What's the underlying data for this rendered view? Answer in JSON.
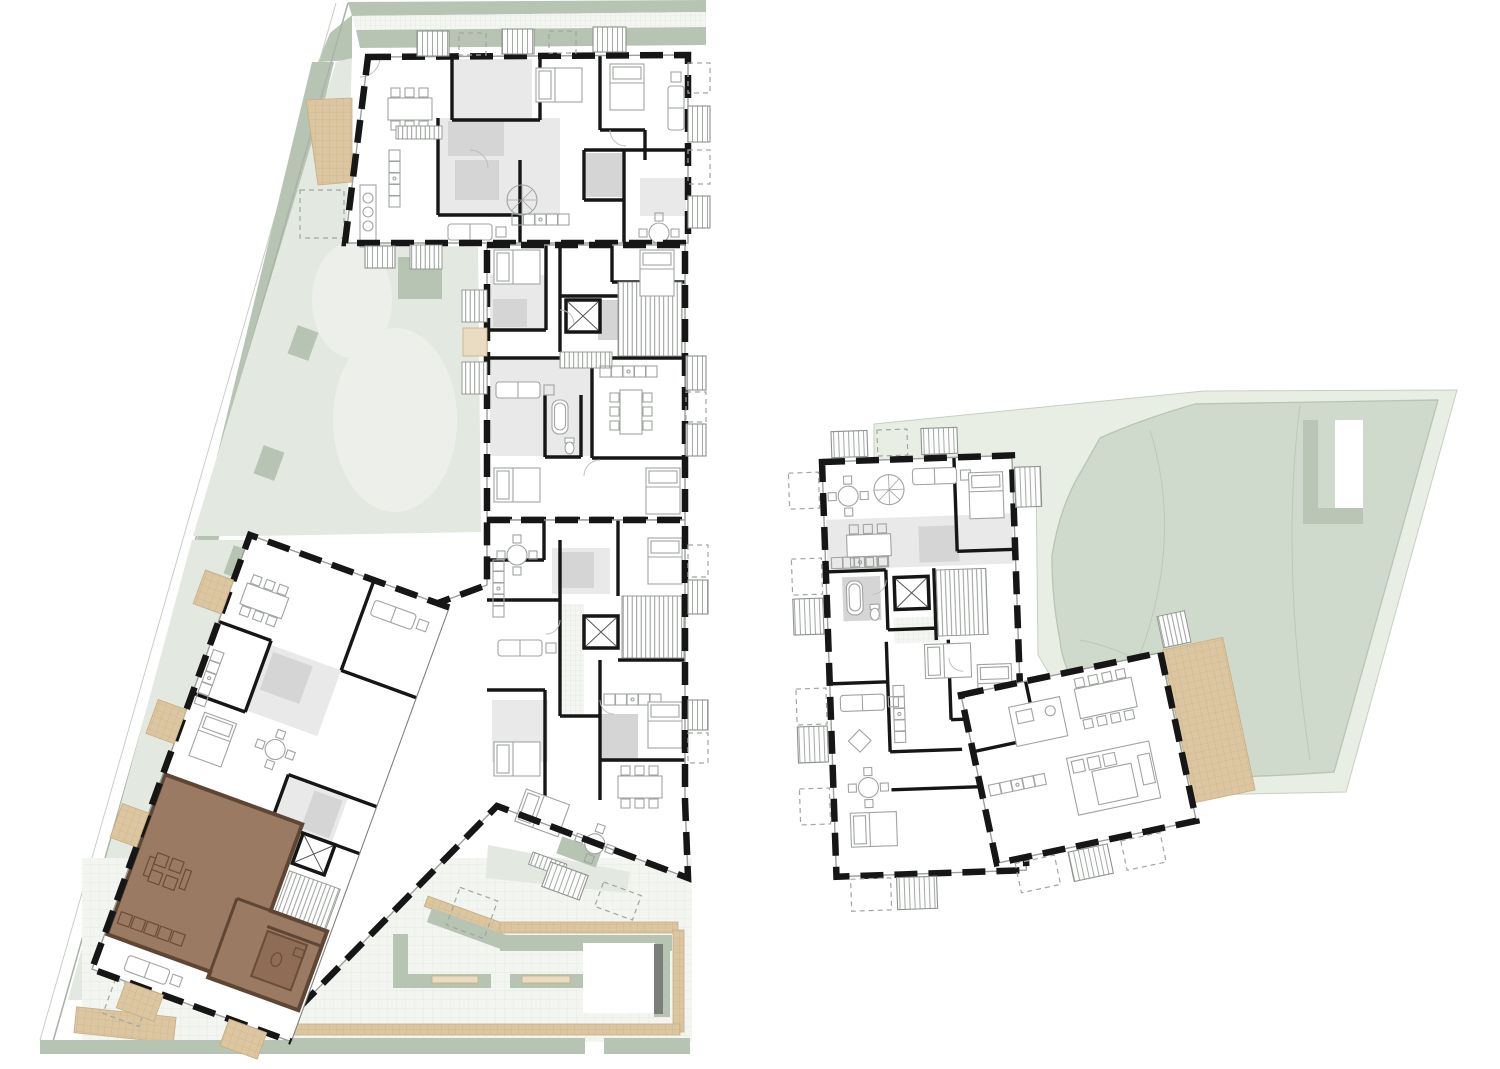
{
  "page": {
    "background": "#ffffff",
    "kind": "architectural-site-plan",
    "content_note": "two residential buildings shown in furnished floor-plan view with surrounding landscape; one apartment unit highlighted brown"
  },
  "colors": {
    "background": "#ffffff",
    "wall": "#161616",
    "sage": "#b7c4b3",
    "pale_green": "#e3e8e0",
    "pale_green_light": "#edf0ea",
    "park_pale": "#e9eee5",
    "park_blob": "#d0dacc",
    "park_line": "#b9c6b5",
    "tan": "#dcc6a1",
    "tan_light": "#e9dcc2",
    "tan_line": "#c7ad82",
    "plaza": "#f3f5f1",
    "plaza_line": "#e4e8e0",
    "room_grey": "#e9e9e9",
    "wet_grey": "#d5d5d5",
    "furniture_line": "#a0a5a0",
    "highlight": "#9b7a63",
    "highlight_dark": "#5f4634",
    "bench_dark": "#7a7f7a"
  },
  "highlighted_unit": {
    "present": true,
    "fill_color": "#9b7a63",
    "wall_color": "#5f4634",
    "location": "southwest-wing-of-west-building"
  },
  "buildings": {
    "west": {
      "blocks": 4,
      "has_rotated_wing": true,
      "elevator_cores": 3
    },
    "east": {
      "blocks": 2,
      "has_rotated_wing": true,
      "elevator_cores": 1,
      "has_terrace": true
    }
  }
}
